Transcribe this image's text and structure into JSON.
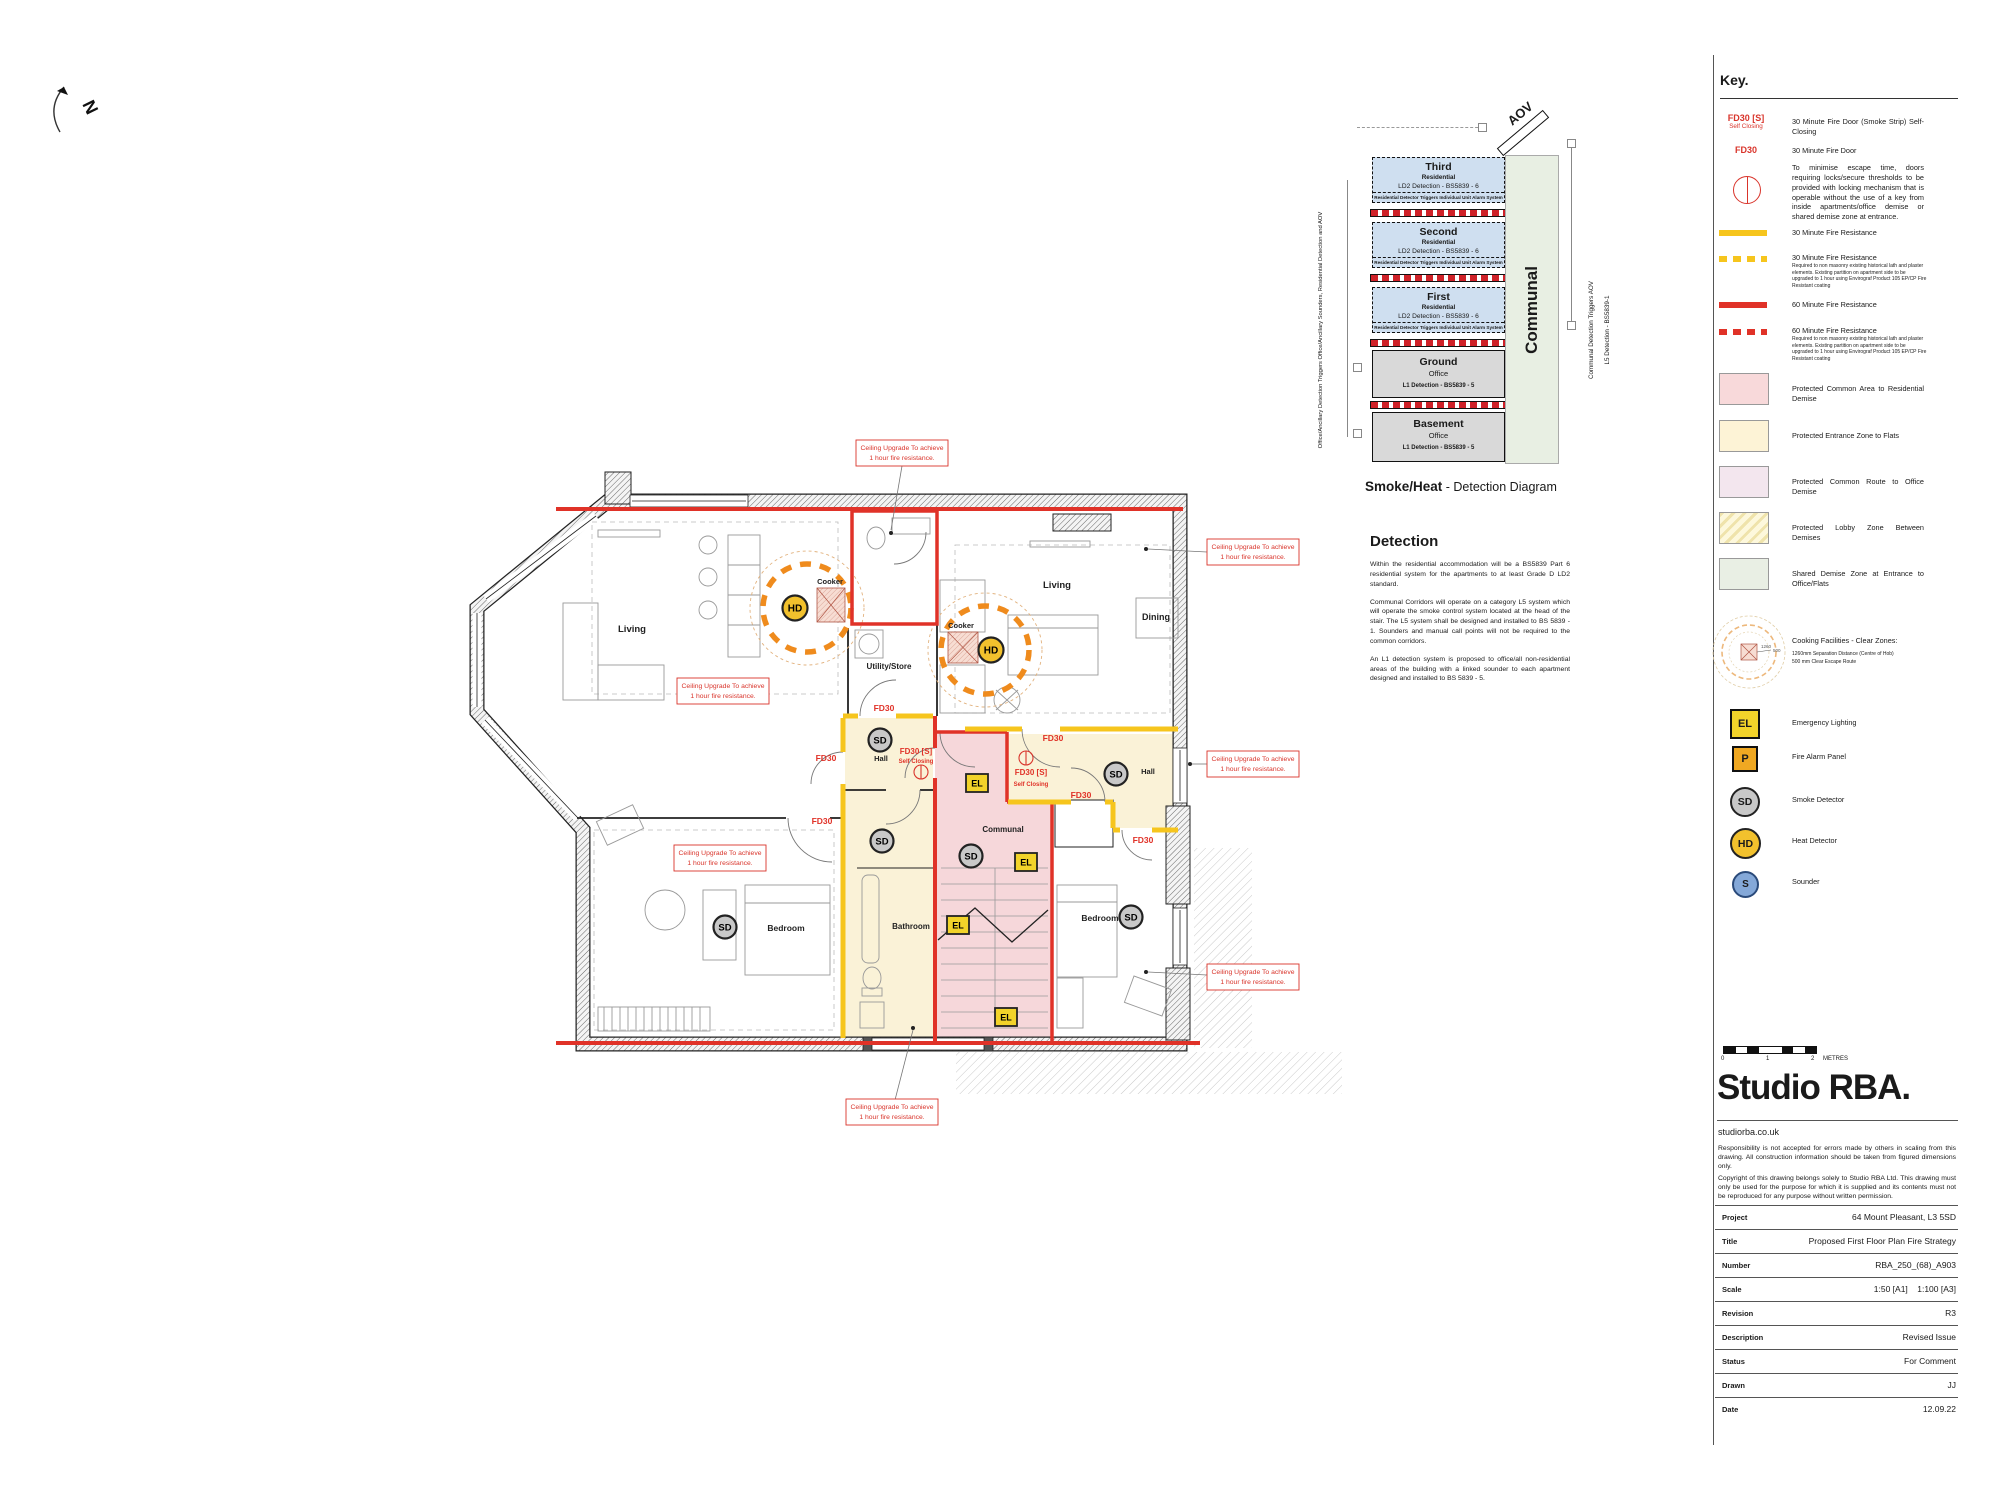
{
  "north": {
    "label": "N"
  },
  "detection_diagram": {
    "caption_bold": "Smoke/Heat",
    "caption_rest": " - Detection Diagram",
    "aov_label": "AOV",
    "communal_label": "Communal",
    "left_note": "Office/Ancillary Detection Triggers Office/Ancillary Sounders, Residential Detection and AOV",
    "right_note_1": "Communal Detection Triggers AOV",
    "right_note_2": "L5 Detection - BS5839-1",
    "floors": [
      {
        "name": "Third",
        "use": "Residential",
        "detection": "LD2 Detection - BS5839 - 6",
        "note": "Residential Detector Triggers Individual Unit Alarm System"
      },
      {
        "name": "Second",
        "use": "Residential",
        "detection": "LD2 Detection - BS5839 - 6",
        "note": "Residential Detector Triggers Individual Unit Alarm System"
      },
      {
        "name": "First",
        "use": "Residential",
        "detection": "LD2 Detection - BS5839 - 6",
        "note": "Residential Detector Triggers Individual Unit Alarm System"
      },
      {
        "name": "Ground",
        "use": "Office",
        "detection": "L1 Detection - BS5839 - 5",
        "note": ""
      },
      {
        "name": "Basement",
        "use": "Office",
        "detection": "L1 Detection - BS5839 - 5",
        "note": ""
      }
    ]
  },
  "detection_text": {
    "heading": "Detection",
    "p1": "Within the residential accommodation will be a BS5839 Part 6 residential system for the apartments to at least Grade D LD2 standard.",
    "p2": "Communal Corridors will operate on a category L5 system which will operate the smoke control system located at the head of the stair. The L5 system shall be designed and installed to BS 5839 - 1. Sounders and manual call points will not be required to the common corridors.",
    "p3": "An L1 detection system is proposed to office/all non-residential areas of the building with a linked sounder to each apartment designed and installed to BS 5839 - 5."
  },
  "key": {
    "heading": "Key.",
    "fd30s_label": "FD30 [S]",
    "fd30s_sub": "Self Closing",
    "fd30s_desc": "30 Minute Fire Door (Smoke Strip) Self-Closing",
    "fd30_label": "FD30",
    "fd30_desc": "30 Minute Fire Door",
    "lock_desc": "To minimise escape time, doors requiring locks/secure thresholds to be provided with locking mechanism that is operable without the use of a key from inside apartments/office demise or shared demise zone at entrance.",
    "res30": "30 Minute Fire Resistance",
    "res30_dashed": "30 Minute Fire Resistance",
    "res60": "60 Minute Fire Resistance",
    "res60_dashed": "60 Minute Fire Resistance",
    "upgrade_note": "Required to non masonry existing historical lath and plaster elements. Existing partition on apartment side to be upgraded to 1 hour using Envirograf Product 105 EP/CP Fire Resistant coating",
    "swatches": [
      {
        "label": "Protected Common Area to Residential Demise",
        "color": "#f8d9da"
      },
      {
        "label": "Protected Entrance Zone to Flats",
        "color": "#fdf3d6"
      },
      {
        "label": "Protected Common Route to Office Demise",
        "color": "#f3e6ee"
      },
      {
        "label": "Protected Lobby Zone Between Demises",
        "color": "#fdf8dc"
      },
      {
        "label": "Shared Demise Zone at Entrance to Office/Flats",
        "color": "#e9efe4"
      }
    ],
    "cooking_label": "Cooking Facilities - Clear Zones:",
    "cooking_note_1": "1260mm Separation Distance (Centre of Hob)",
    "cooking_note_2": "500 mm Clear Escape Route",
    "cooking_dim_1": "1260",
    "cooking_dim_2": "500",
    "devices": [
      {
        "symbol": "EL",
        "label": "Emergency Lighting",
        "color": "#f2d32a"
      },
      {
        "symbol": "P",
        "label": "Fire Alarm Panel",
        "color": "#f0a822"
      },
      {
        "symbol": "SD",
        "label": "Smoke Detector",
        "color": "#c8c8c8"
      },
      {
        "symbol": "HD",
        "label": "Heat Detector",
        "color": "#f2c12d"
      },
      {
        "symbol": "S",
        "label": "Sounder",
        "color": "#84a8d8"
      }
    ]
  },
  "titleblock": {
    "scale_labels": [
      "0",
      "1",
      "2"
    ],
    "scale_unit": "METRES",
    "logo": "Studio RBA.",
    "website": "studiorba.co.uk",
    "disclaimer_1": "Responsibility is not accepted for errors made by others in scaling from this drawing. All construction information should be taken from figured dimensions only.",
    "disclaimer_2": "Copyright of this drawing belongs solely to Studio RBA Ltd. This drawing must only be used for the purpose for which it is supplied and its contents must not be reproduced for any purpose without written permission.",
    "rows": [
      {
        "label": "Project",
        "value": "64 Mount Pleasant, L3 5SD"
      },
      {
        "label": "Title",
        "value": "Proposed First Floor Plan Fire Strategy"
      },
      {
        "label": "Number",
        "value": "RBA_250_(68)_A903"
      },
      {
        "label": "Scale",
        "value": "1:50 [A1]    1:100 [A3]"
      },
      {
        "label": "Revision",
        "value": "R3"
      },
      {
        "label": "Description",
        "value": "Revised Issue"
      },
      {
        "label": "Status",
        "value": "For Comment"
      },
      {
        "label": "Drawn",
        "value": "JJ"
      },
      {
        "label": "Date",
        "value": "12.09.22"
      }
    ]
  },
  "plan": {
    "rooms": {
      "living_left": "Living",
      "living_right": "Living",
      "dining": "Dining",
      "utility": "Utility/Store",
      "hall_left": "Hall",
      "hall_right": "Hall",
      "communal": "Communal",
      "bedroom_left": "Bedroom",
      "bedroom_right": "Bedroom",
      "bathroom": "Bathroom",
      "cooker": "Cooker"
    },
    "symbols": {
      "sd": "SD",
      "hd": "HD",
      "el": "EL"
    },
    "fd30": "FD30",
    "fd30_s": "FD30 [S]",
    "self_closing": "Self Closing",
    "ceiling_note_l1": "Ceiling Upgrade To achieve",
    "ceiling_note_l2": "1 hour fire resistance.",
    "colors": {
      "fire60": "#e03228",
      "fire30": "#f6c51d",
      "communal_zone": "#f6d7da",
      "entrance_zone": "#faf2d7",
      "cooker_ring": "#ef8b1d"
    }
  }
}
